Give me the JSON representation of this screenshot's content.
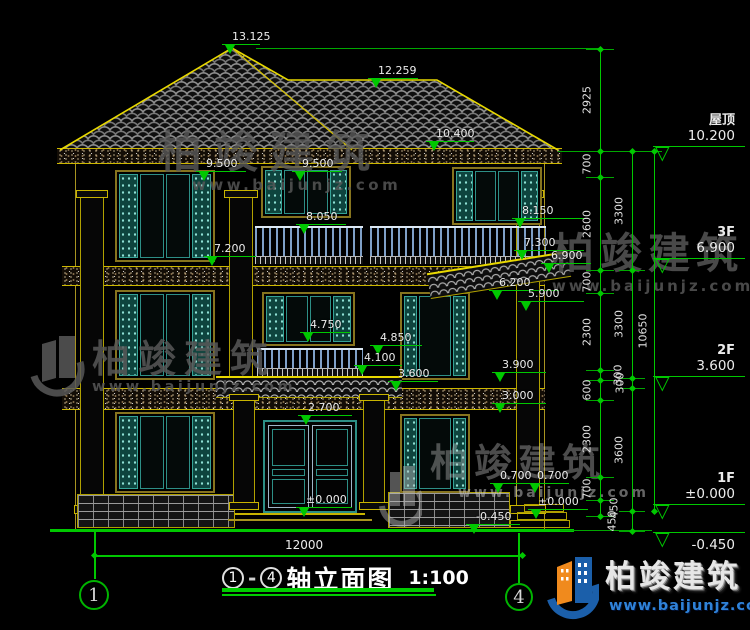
{
  "drawing": {
    "title": {
      "axis_start": "1",
      "sep": "-",
      "axis_end": "4",
      "name": "轴立面图",
      "scale": "1:100"
    },
    "bottom_dimension": "12000",
    "grid_bubbles": [
      "1",
      "4"
    ],
    "floor_levels": [
      {
        "floor": "屋顶",
        "value": "10.200",
        "x": 653,
        "y": 146,
        "w": 92
      },
      {
        "floor": "3F",
        "value": "6.900",
        "x": 653,
        "y": 258,
        "w": 92
      },
      {
        "floor": "2F",
        "value": "3.600",
        "x": 653,
        "y": 376,
        "w": 92
      },
      {
        "floor": "1F",
        "value": "±0.000",
        "x": 653,
        "y": 504,
        "w": 92
      },
      {
        "floor": "",
        "value": "-0.450",
        "x": 653,
        "y": 532,
        "w": 92,
        "below": true
      }
    ],
    "elevation_markers": [
      {
        "label": "13.125",
        "x": 222,
        "y": 44,
        "w": 38
      },
      {
        "label": "12.259",
        "x": 368,
        "y": 78,
        "w": 50
      },
      {
        "label": "10.400",
        "x": 426,
        "y": 141,
        "w": 48
      },
      {
        "label": "9.500",
        "x": 196,
        "y": 171,
        "w": 50
      },
      {
        "label": "9.500",
        "x": 292,
        "y": 171,
        "w": 50
      },
      {
        "label": "8.050",
        "x": 296,
        "y": 224,
        "w": 50
      },
      {
        "label": "7.200",
        "x": 204,
        "y": 256,
        "w": 52
      },
      {
        "label": "8.150",
        "x": 512,
        "y": 218,
        "w": 72
      },
      {
        "label": "7.300",
        "x": 514,
        "y": 250,
        "w": 70
      },
      {
        "label": "6.900",
        "x": 541,
        "y": 263,
        "w": 50
      },
      {
        "label": "6.200",
        "x": 489,
        "y": 290,
        "w": 70
      },
      {
        "label": "5.900",
        "x": 518,
        "y": 301,
        "w": 66
      },
      {
        "label": "4.750",
        "x": 300,
        "y": 332,
        "w": 50
      },
      {
        "label": "4.850",
        "x": 370,
        "y": 345,
        "w": 52
      },
      {
        "label": "4.100",
        "x": 354,
        "y": 365,
        "w": 48
      },
      {
        "label": "3.600",
        "x": 388,
        "y": 381,
        "w": 50
      },
      {
        "label": "3.900",
        "x": 492,
        "y": 372,
        "w": 54
      },
      {
        "label": "3.000",
        "x": 492,
        "y": 403,
        "w": 54
      },
      {
        "label": "2.700",
        "x": 298,
        "y": 415,
        "w": 54
      },
      {
        "label": "0.700",
        "x": 490,
        "y": 483,
        "w": 42
      },
      {
        "label": "0.700",
        "x": 527,
        "y": 483,
        "w": 42
      },
      {
        "label": "±0.000",
        "x": 296,
        "y": 507,
        "w": 56
      },
      {
        "label": "±0.000",
        "x": 528,
        "y": 509,
        "w": 60
      },
      {
        "label": "-0.450",
        "x": 466,
        "y": 524,
        "w": 54
      }
    ],
    "dim_chains": [
      {
        "x": 600,
        "tick": 28,
        "segs": [
          {
            "v": "2925",
            "y0": 49,
            "y1": 151
          },
          {
            "v": "700",
            "y0": 151,
            "y1": 177
          },
          {
            "v": "2600",
            "y0": 177,
            "y1": 270
          },
          {
            "v": "700",
            "y0": 270,
            "y1": 293
          },
          {
            "v": "2300",
            "y0": 293,
            "y1": 370
          },
          {
            "v": "300",
            "y0": 370,
            "y1": 380,
            "dx": 18
          },
          {
            "v": "600",
            "y0": 380,
            "y1": 400
          },
          {
            "v": "2300",
            "y0": 400,
            "y1": 477
          },
          {
            "v": "700",
            "y0": 477,
            "y1": 500
          },
          {
            "v": "450",
            "y0": 500,
            "y1": 516,
            "dx": 14
          }
        ]
      },
      {
        "x": 632,
        "tick": 26,
        "segs": [
          {
            "v": "3300",
            "y0": 151,
            "y1": 270
          },
          {
            "v": "3300",
            "y0": 270,
            "y1": 378
          },
          {
            "v": "300",
            "y0": 378,
            "y1": 388,
            "dx": -12
          },
          {
            "v": "3600",
            "y0": 388,
            "y1": 511
          },
          {
            "v": "450",
            "y0": 511,
            "y1": 531,
            "dx": -20
          }
        ]
      },
      {
        "x": 654,
        "tick": 0,
        "segs": [
          {
            "v": "10650",
            "y0": 151,
            "y1": 511,
            "dx": -11
          }
        ]
      }
    ]
  },
  "watermark": {
    "brand": "柏竣建筑",
    "url": "www.baijunjz.com"
  },
  "logo": {
    "brand": "柏竣建筑",
    "url": "www.baijunjz.com"
  },
  "colors": {
    "line_green": "#00c800",
    "line_yellow": "#d8c400",
    "window_teal": "#35a396",
    "text": "#ececec",
    "logo_blue": "#1b5faa",
    "logo_orange": "#f08a1d"
  }
}
